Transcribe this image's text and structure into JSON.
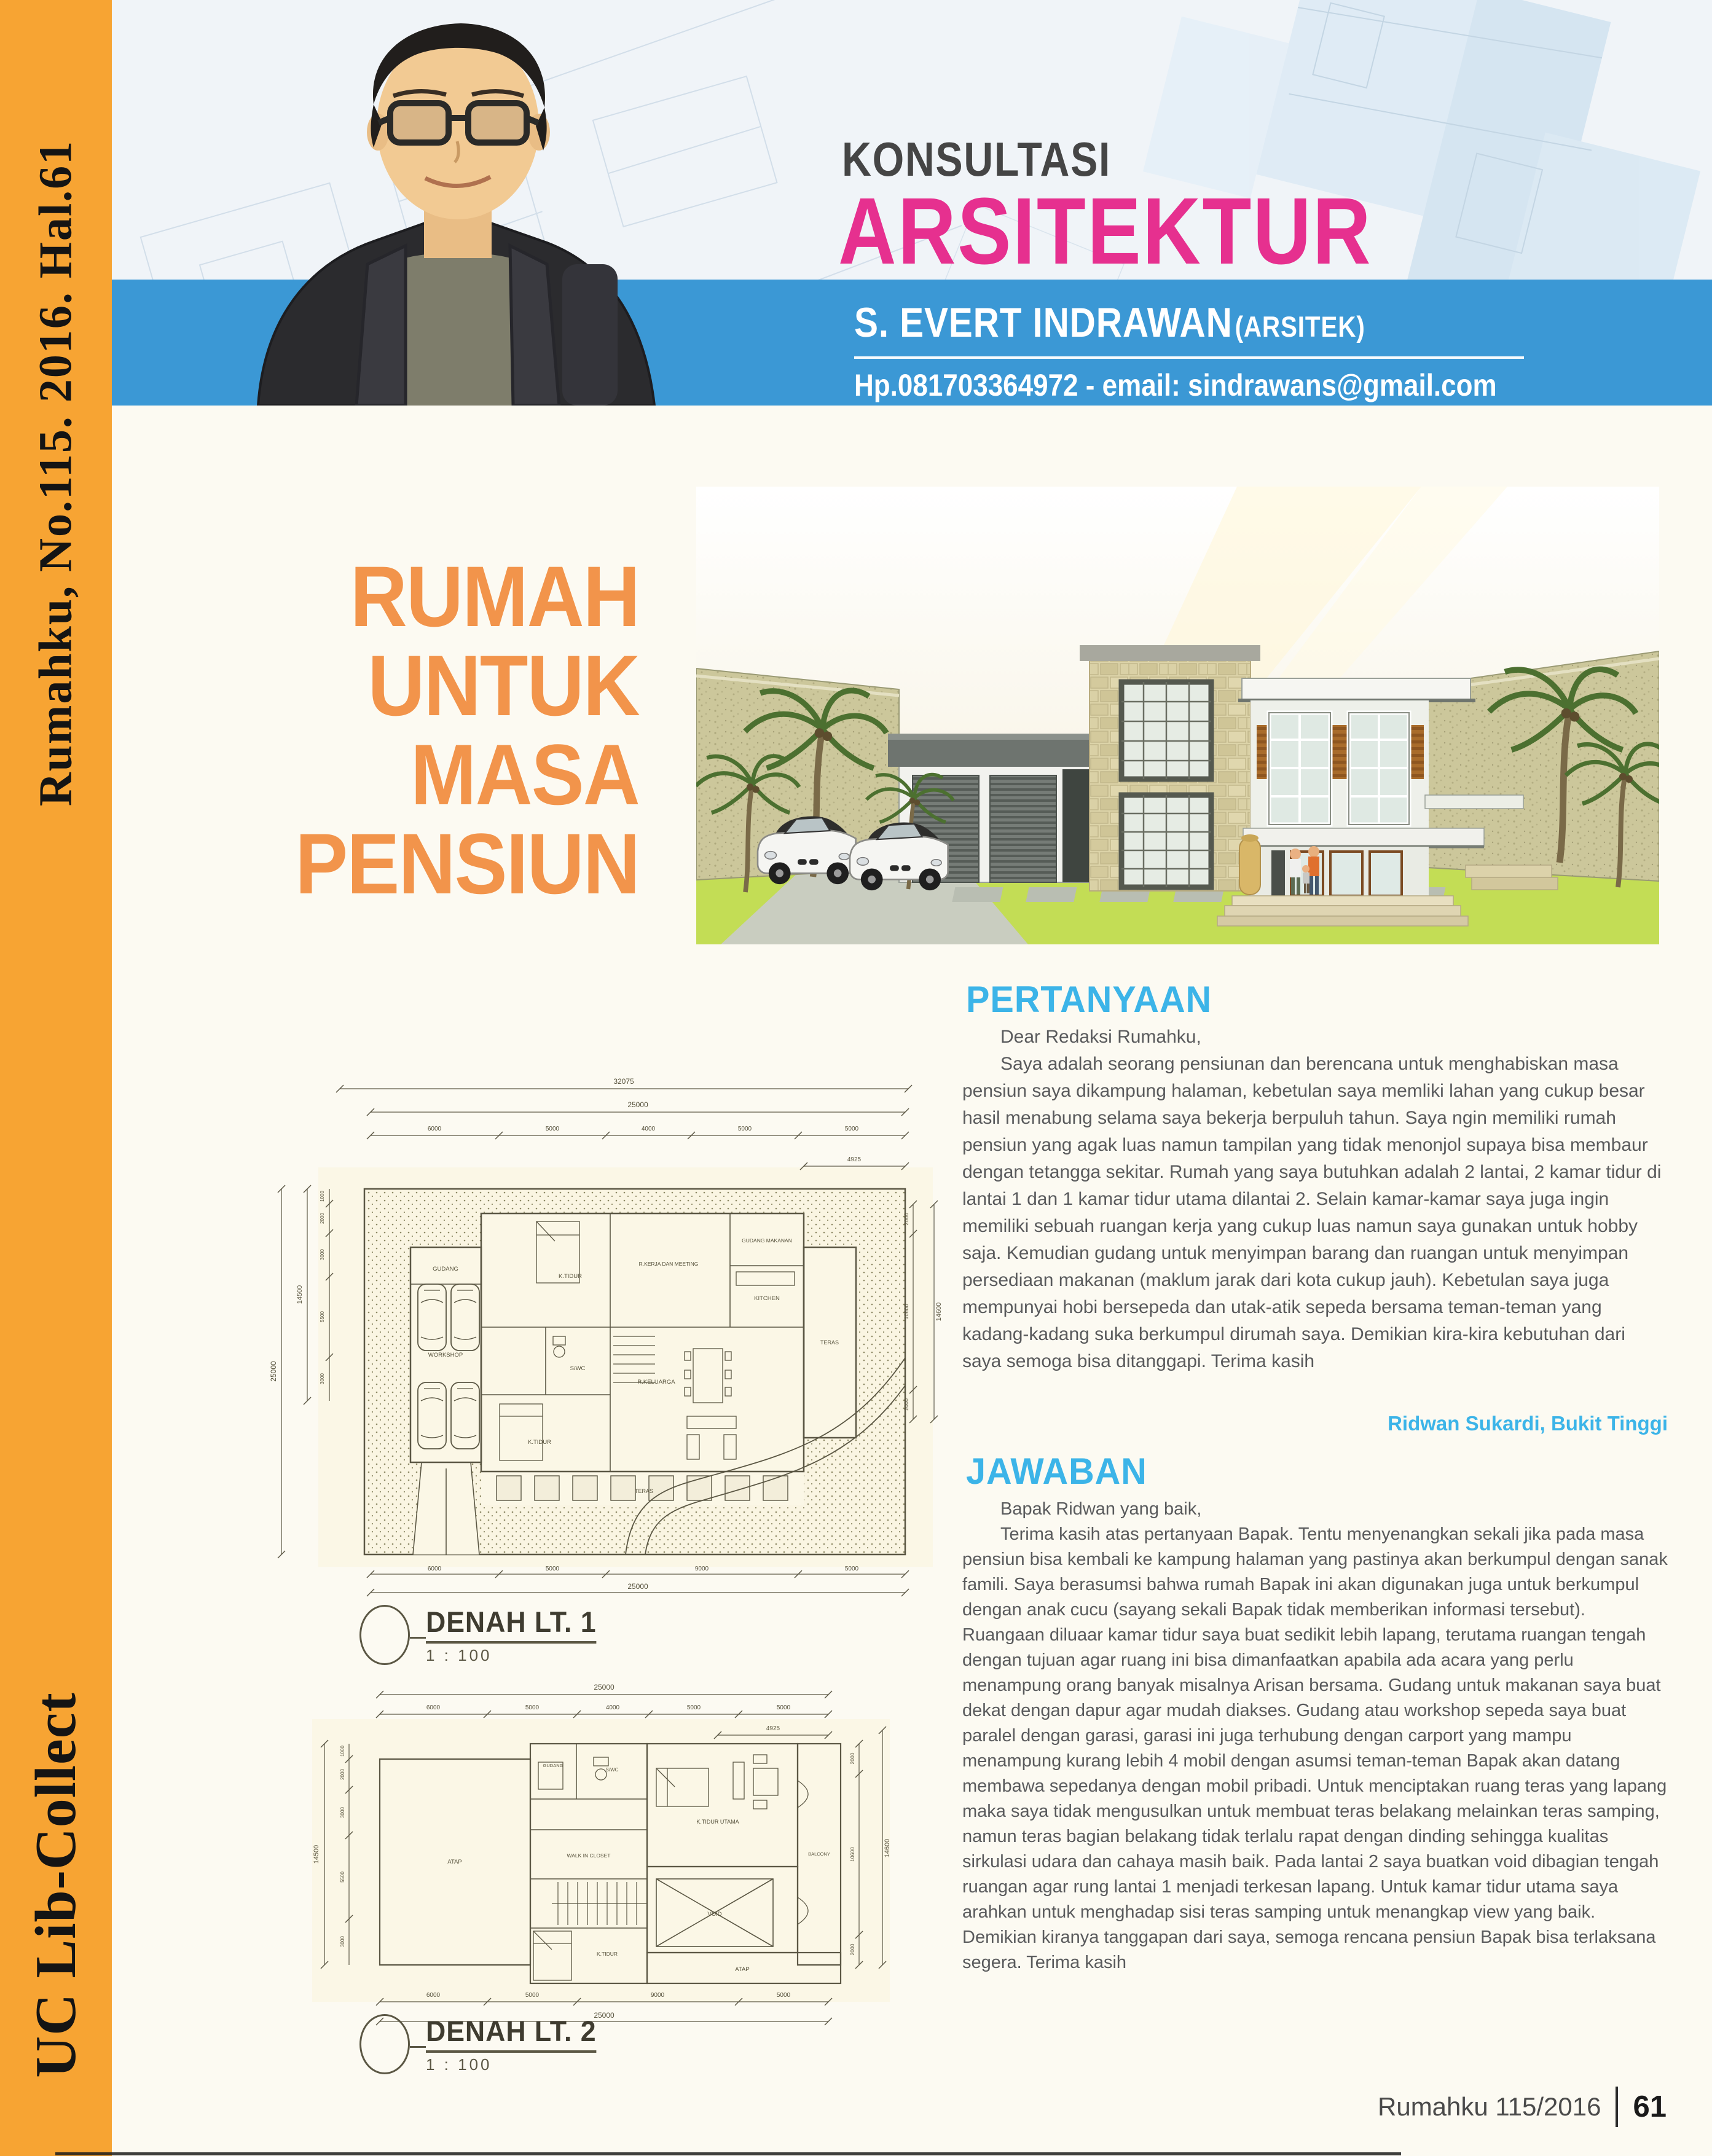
{
  "sidebar": {
    "top_text": "Rumahku, No.115. 2016. Hal.61",
    "bottom_text": "UC Lib-Collect",
    "bg_color": "#F7A433"
  },
  "header": {
    "kicker": "KONSULTASI",
    "title": "ARSITEKTUR",
    "title_color": "#E6308F",
    "band_color": "#3B98D5",
    "architect_name": "S. EVERT INDRAWAN",
    "architect_suffix": "(ARSITEK)",
    "contact": "Hp.081703364972 - email: sindrawans@gmail.com"
  },
  "article": {
    "headline": [
      "RUMAH",
      "UNTUK",
      "MASA",
      "PENSIUN"
    ],
    "headline_color": "#F2944B",
    "accent_color": "#3CB4E8",
    "question": {
      "heading": "PERTANYAAN",
      "salutation": "Dear Redaksi Rumahku,",
      "body": "Saya adalah seorang pensiunan dan berencana untuk menghabiskan masa pensiun saya dikampung halaman, kebetulan saya memliki lahan yang cukup besar hasil menabung selama saya bekerja berpuluh tahun. Saya ngin memiliki rumah pensiun yang agak luas namun tampilan yang tidak menonjol supaya bisa membaur dengan tetangga sekitar. Rumah yang saya butuhkan adalah 2 lantai, 2 kamar tidur di lantai 1 dan 1 kamar tidur utama dilantai 2. Selain kamar-kamar saya juga ingin memiliki sebuah ruangan kerja yang cukup luas namun saya gunakan untuk hobby saja. Kemudian gudang untuk menyimpan barang dan ruangan untuk menyimpan persediaan makanan (maklum jarak dari kota cukup jauh). Kebetulan saya juga mempunyai hobi bersepeda dan utak-atik sepeda bersama teman-teman yang kadang-kadang suka berkumpul dirumah saya. Demikian kira-kira kebutuhan dari saya semoga bisa ditanggapi. Terima kasih",
      "signature": "Ridwan Sukardi, Bukit Tinggi"
    },
    "answer": {
      "heading": "JAWABAN",
      "salutation": "Bapak Ridwan yang baik,",
      "body": "Terima kasih atas pertanyaan Bapak. Tentu menyenangkan sekali jika pada masa pensiun bisa kembali ke kampung halaman yang pastinya akan berkumpul dengan sanak famili. Saya berasumsi bahwa rumah Bapak ini akan digunakan juga untuk berkumpul dengan anak cucu (sayang sekali Bapak tidak memberikan informasi tersebut). Ruangaan diluaar kamar tidur saya buat sedikit lebih lapang, terutama ruangan tengah dengan tujuan agar ruang ini bisa dimanfaatkan apabila ada acara yang perlu menampung orang banyak misalnya Arisan bersama. Gudang untuk makanan saya buat dekat dengan dapur agar mudah diakses. Gudang atau workshop sepeda saya buat paralel dengan garasi, garasi ini juga terhubung dengan carport yang mampu menampung kurang lebih 4 mobil dengan asumsi teman-teman Bapak akan datang membawa sepedanya dengan mobil pribadi. Untuk menciptakan ruang teras yang lapang maka saya tidak mengusulkan untuk membuat teras belakang melainkan teras samping, namun teras bagian belakang tidak terlalu rapat dengan dinding sehingga kualitas sirkulasi udara dan cahaya masih baik. Pada lantai 2 saya buatkan void dibagian tengah ruangan agar rung lantai 1 menjadi terkesan lapang. Untuk kamar tidur utama saya arahkan untuk menghadap sisi teras samping untuk menangkap view yang baik. Demikian kiranya tanggapan dari saya, semoga rencana pensiun Bapak bisa terlaksana segera. Terima kasih"
    }
  },
  "plans": {
    "plan1": {
      "label": "DENAH LT. 1",
      "scale": "1 : 100",
      "dims": {
        "top_outer": "32075",
        "top_total": "25000",
        "top_segments": [
          "6000",
          "5000",
          "4000",
          "5000",
          "5000"
        ],
        "left_outer": "25000",
        "left_total": "14500",
        "left_segments": [
          "1000",
          "2000",
          "3000",
          "5500",
          "3000"
        ],
        "right_total": "14600",
        "right_segments": [
          "2000",
          "10600",
          "2000"
        ],
        "right_offset": "4925",
        "bottom_segments": [
          "6000",
          "5000",
          "9000",
          "5000"
        ],
        "bottom_total": "25000"
      },
      "rooms": [
        "GUDANG",
        "WORKSHOP",
        "K.TIDUR",
        "R.KERJA DAN MEETING",
        "GUDANG MAKANAN",
        "KITCHEN",
        "R.KELUARGA",
        "S/WC",
        "K.TIDUR",
        "TERAS",
        "TERAS"
      ]
    },
    "plan2": {
      "label": "DENAH LT. 2",
      "scale": "1 : 100",
      "dims": {
        "top_total": "25000",
        "top_segments": [
          "6000",
          "5000",
          "4000",
          "5000",
          "5000"
        ],
        "top_offset": "4925",
        "left_total": "14500",
        "left_segments": [
          "1000",
          "2000",
          "3000",
          "5500",
          "3000"
        ],
        "right_total": "14600",
        "right_segments": [
          "2000",
          "10600",
          "2000"
        ],
        "bottom_segments": [
          "6000",
          "5000",
          "9000",
          "5000"
        ],
        "bottom_total": "25000"
      },
      "rooms": [
        "ATAP",
        "GUDANG",
        "S/WC",
        "K.TIDUR UTAMA",
        "WALK IN CLOSET",
        "VOID",
        "K.TIDUR",
        "BALCONY",
        "ATAP"
      ]
    }
  },
  "footer": {
    "issue": "Rumahku 115/2016",
    "page": "61"
  }
}
